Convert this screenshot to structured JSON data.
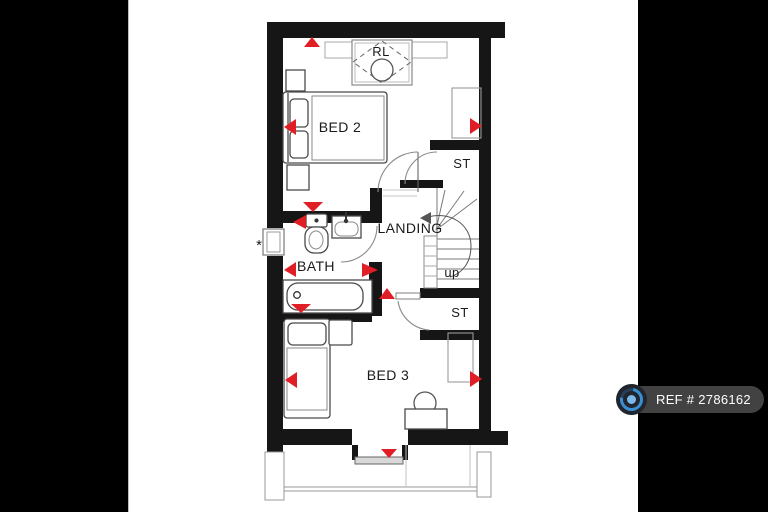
{
  "window": {
    "width": 768,
    "height": 512
  },
  "letterbox": {
    "color": "#000000"
  },
  "floorplan": {
    "background": "#ffffff",
    "wall_color": "#161616",
    "arrow_color": "#e01e26",
    "labels": {
      "rooflight": "RL",
      "bed2": "BED 2",
      "storage_upper": "ST",
      "landing": "LANDING",
      "stairs_direction": "up",
      "bath": "BATH",
      "storage_lower": "ST",
      "bed3": "BED 3",
      "asterisk": "*"
    }
  },
  "badge": {
    "ref_text": "REF # 2786162",
    "background": "#424242",
    "text_color": "#ffffff",
    "icon": {
      "name": "camera-360-icon",
      "body": "#20252e",
      "ring_blue": "#3a8ed2",
      "center_blue": "#7db9e8"
    }
  }
}
